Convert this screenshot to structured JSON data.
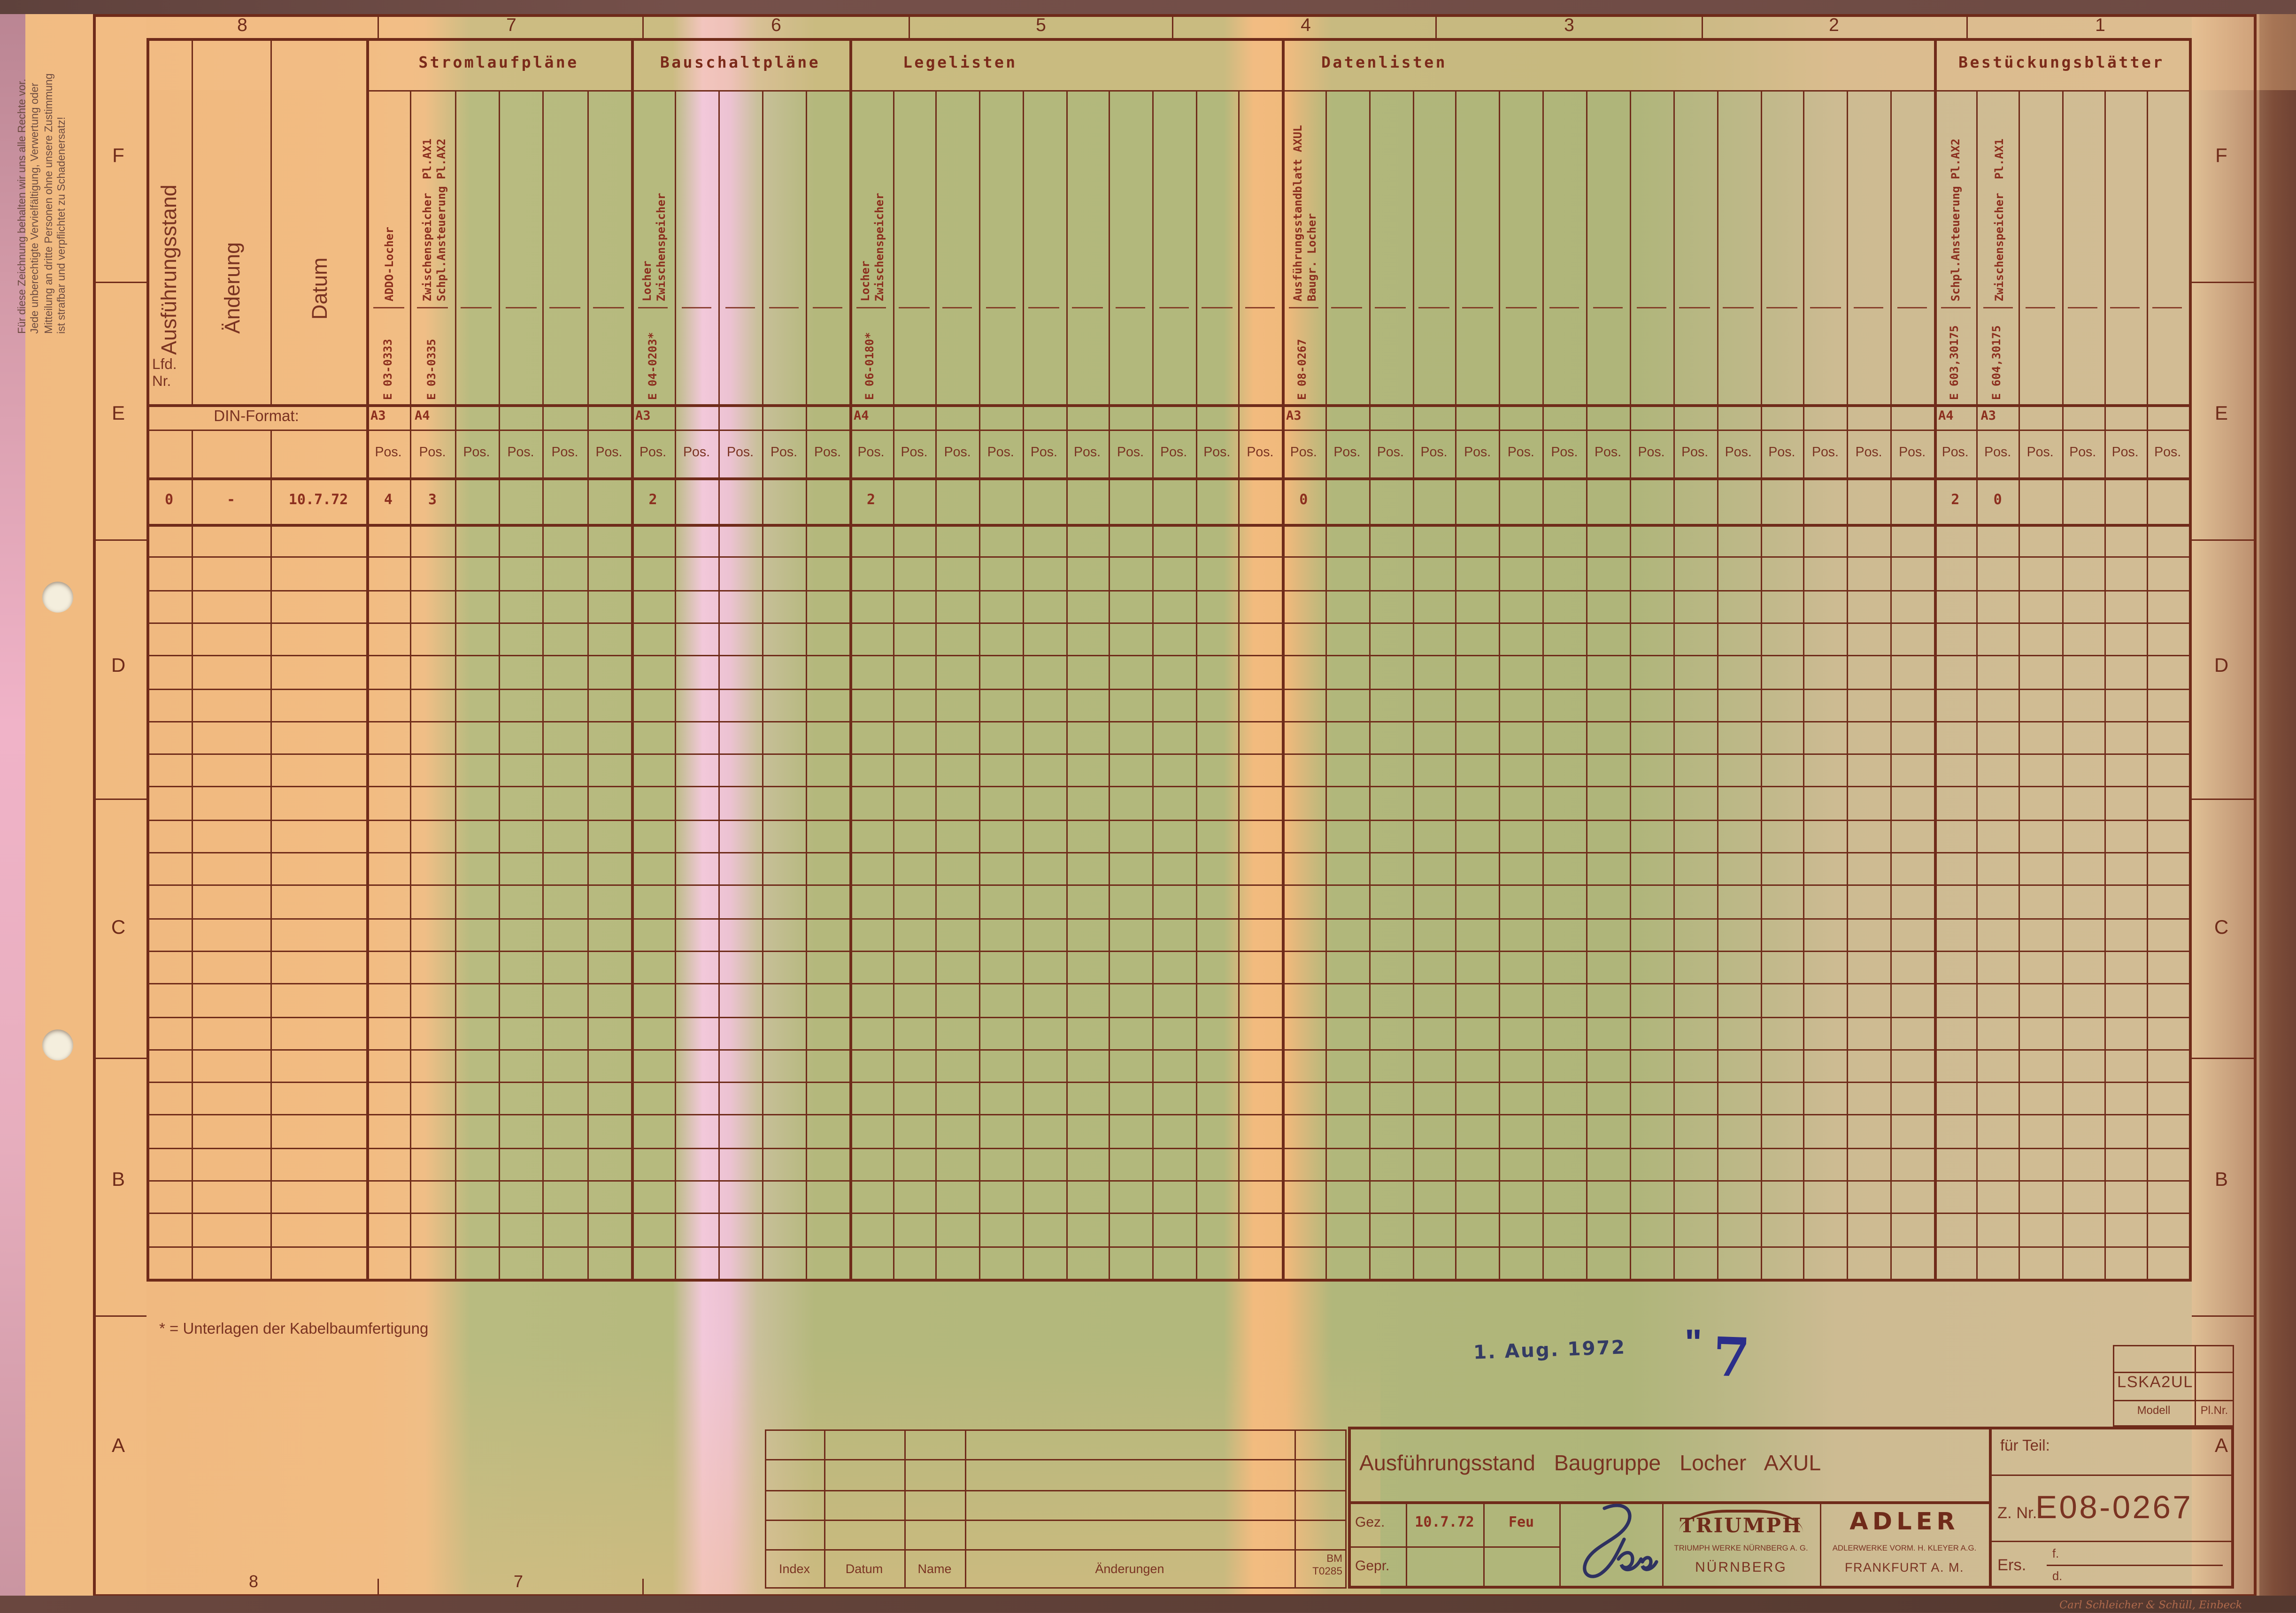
{
  "colors": {
    "line": "#6f2b1a",
    "print_text": "#7a3322",
    "typed_text": "#8c2f1f",
    "ink_blue": "#2e3160",
    "stamp_blue": "#343b63",
    "paper_green": "#b4b87c",
    "paper_orange": "#f0b97e",
    "paper_pink": "#f2c8da"
  },
  "copyright_notice": "Für diese Zeichnung behalten wir uns alle Rechte vor.\nJede unberechtigte Vervielfältigung, Verwertung oder\nMitteilung an dritte Personen ohne unsere Zustimmung\nist strafbar und verpflichtet zu Schadenersatz!",
  "ruler": {
    "top": [
      "8",
      "7",
      "6",
      "5",
      "4",
      "3",
      "2",
      "1"
    ],
    "bottom": [
      "8",
      "7"
    ],
    "letters": [
      "F",
      "E",
      "D",
      "C",
      "B",
      "A"
    ]
  },
  "left_table": {
    "col_ausfuehrungsstand": "Ausführungsstand",
    "lfd": "Lfd.",
    "nr": "Nr.",
    "col_aenderung": "Änderung",
    "col_datum": "Datum",
    "din_label": "DIN-Format:"
  },
  "pos_label": "Pos.",
  "sections": [
    {
      "label": "Stromlaufpläne",
      "cols": 6,
      "entries": [
        {
          "col": 0,
          "name": "ADDO-Locher",
          "number": "E 03-0333",
          "format": "A3",
          "pos": "4"
        },
        {
          "col": 1,
          "name": "Zwischenspeicher  Pl.AX1\nSchpl.Ansteuerung Pl.AX2",
          "number": "E 03-0335",
          "format": "A4",
          "pos": "3"
        }
      ]
    },
    {
      "label": "Bauschaltpläne",
      "cols": 5,
      "entries": [
        {
          "col": 0,
          "name": "Locher\nZwischenspeicher",
          "number": "E 04-0203*",
          "format": "A3",
          "pos": "2"
        }
      ]
    },
    {
      "label": "Legelisten",
      "cols": 10,
      "entries": [
        {
          "col": 0,
          "name": "Locher\nZwischenspeicher",
          "number": "E 06-0180*",
          "format": "A4",
          "pos": "2"
        }
      ]
    },
    {
      "label": "Datenlisten",
      "cols": 15,
      "entries": [
        {
          "col": 0,
          "name": "Ausführungsstandblatt AXUL\nBaugr. Locher",
          "number": "E 08-0267",
          "format": "A3",
          "pos": "0"
        }
      ]
    },
    {
      "label": "Bestückungsblätter",
      "cols": 6,
      "entries": [
        {
          "col": 0,
          "name": "Schpl.Ansteuerung Pl.AX2",
          "number": "E 603,30175",
          "format": "A4",
          "pos": "2"
        },
        {
          "col": 1,
          "name": "Zwischenspeicher  Pl.AX1",
          "number": "E 604,30175",
          "format": "A3",
          "pos": "0"
        }
      ]
    }
  ],
  "first_row": {
    "lfd": "0",
    "aenderung": "-",
    "datum": "10.7.72"
  },
  "footnote": "* = Unterlagen der Kabelbaumfertigung",
  "stamp": {
    "date": "1. Aug. 1972",
    "ditto_mark": "\"",
    "handwritten_number": "7"
  },
  "model_box": {
    "model": "LSKA2UL",
    "modell_label": "Modell",
    "plnr_label": "Pl.Nr."
  },
  "revision_table": {
    "headers": [
      "Index",
      "Datum",
      "Name",
      "Änderungen"
    ],
    "bm_line1": "BM",
    "bm_line2": "T0285",
    "empty_rows": 4
  },
  "title_block": {
    "title": "Ausführungsstand Baugruppe Locher AXUL",
    "gez_label": "Gez.",
    "gez_date": "10.7.72",
    "gez_name": "Feu",
    "gepr_label": "Gepr.",
    "triumph_logo": "TRIUMPH",
    "triumph_line1": "TRIUMPH WERKE NÜRNBERG A. G.",
    "triumph_line2": "NÜRNBERG",
    "adler_logo": "ADLER",
    "adler_line1": "ADLERWERKE VORM. H. KLEYER A.G.",
    "adler_line2": "FRANKFURT A. M.",
    "fuer_teil_label": "für Teil:",
    "znr_label": "Z. Nr.",
    "znr_value": "E08-0267",
    "ers_label": "Ers.",
    "ers_f": "f.",
    "ers_d": "d."
  },
  "manufacturer": "Carl Schleicher & Schüll, Einbeck"
}
